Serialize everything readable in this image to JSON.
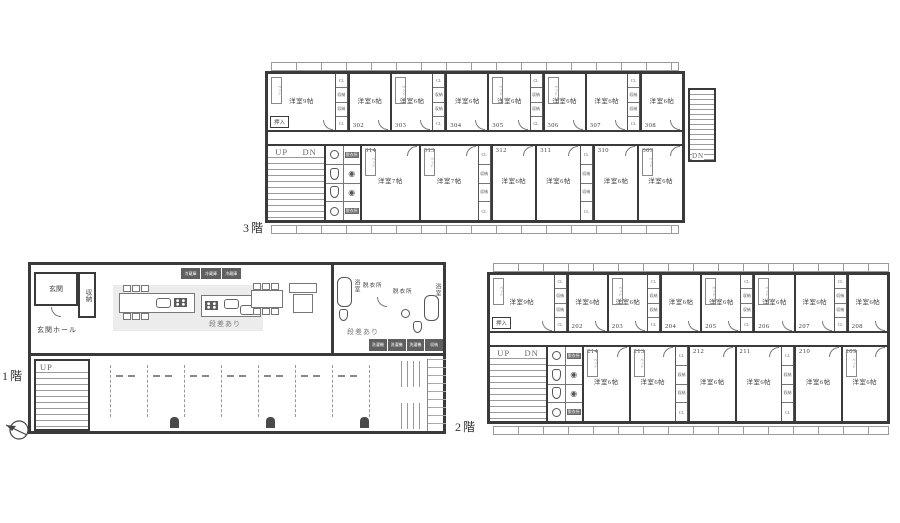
{
  "common": {
    "up": "UP",
    "dn": "DN",
    "closet_labels": [
      "CL",
      "収納",
      "収納",
      "CL"
    ],
    "oshiire": "押入",
    "bed": "ベッド",
    "dressing": "脱衣所"
  },
  "floor3": {
    "caption": "3階",
    "ext_stair_dn": "DN",
    "top_rooms": [
      {
        "no": "301",
        "size": "洋室9帖",
        "wide": true,
        "bed": true,
        "oshiire": true
      },
      {
        "no": "302",
        "size": "洋室6帖",
        "closet": true
      },
      {
        "no": "303",
        "size": "洋室6帖",
        "bed": true
      },
      {
        "no": "304",
        "size": "洋室6帖",
        "closet": true
      },
      {
        "no": "305",
        "size": "洋室6帖",
        "bed": true
      },
      {
        "no": "306",
        "size": "洋室6帖",
        "closet": true,
        "bed": true
      },
      {
        "no": "307",
        "size": "洋室6帖"
      },
      {
        "no": "308",
        "size": "洋室6帖",
        "closet": true
      }
    ],
    "bottom_rooms": [
      {
        "no": "314",
        "size": "洋室7帖",
        "bed": true
      },
      {
        "no": "313",
        "size": "洋室7帖",
        "bed": true
      },
      {
        "no": "312",
        "size": "洋室6帖",
        "closet": true
      },
      {
        "no": "311",
        "size": "洋室6帖"
      },
      {
        "no": "310",
        "size": "洋室6帖",
        "closet": true
      },
      {
        "no": "309",
        "size": "洋室6帖",
        "bed": true
      }
    ]
  },
  "floor2": {
    "caption": "2階",
    "top_rooms": [
      {
        "no": "201",
        "size": "洋室9帖",
        "wide": true,
        "bed": true,
        "oshiire": true
      },
      {
        "no": "202",
        "size": "洋室6帖",
        "closet": true
      },
      {
        "no": "203",
        "size": "洋室6帖",
        "bed": true
      },
      {
        "no": "204",
        "size": "洋室6帖",
        "closet": true
      },
      {
        "no": "205",
        "size": "洋室6帖",
        "bed": true
      },
      {
        "no": "206",
        "size": "洋室6帖",
        "closet": true,
        "bed": true
      },
      {
        "no": "207",
        "size": "洋室6帖"
      },
      {
        "no": "208",
        "size": "洋室6帖",
        "closet": true
      }
    ],
    "bottom_rooms": [
      {
        "no": "214",
        "size": "洋室6帖",
        "bed": true
      },
      {
        "no": "213",
        "size": "洋室6帖",
        "bed": true
      },
      {
        "no": "212",
        "size": "洋室6帖",
        "closet": true
      },
      {
        "no": "211",
        "size": "洋室6帖"
      },
      {
        "no": "210",
        "size": "洋室6帖",
        "closet": true
      },
      {
        "no": "209",
        "size": "洋室6帖",
        "bed": true
      }
    ]
  },
  "floor1": {
    "caption": "1階",
    "genkan": "玄関",
    "storage": "収納",
    "hall": "玄関ホール",
    "up": "UP",
    "fridges": [
      "冷蔵庫",
      "冷蔵庫",
      "冷蔵庫"
    ],
    "step_note_kitchen": "段差あり",
    "step_note_bath": "段差あり",
    "bath_left": "浴室",
    "dressing_left": "脱衣所",
    "dressing_right": "脱衣所",
    "bath_right": "浴室",
    "laundry": [
      "洗濯機",
      "洗濯機",
      "洗濯機",
      "収納"
    ]
  }
}
